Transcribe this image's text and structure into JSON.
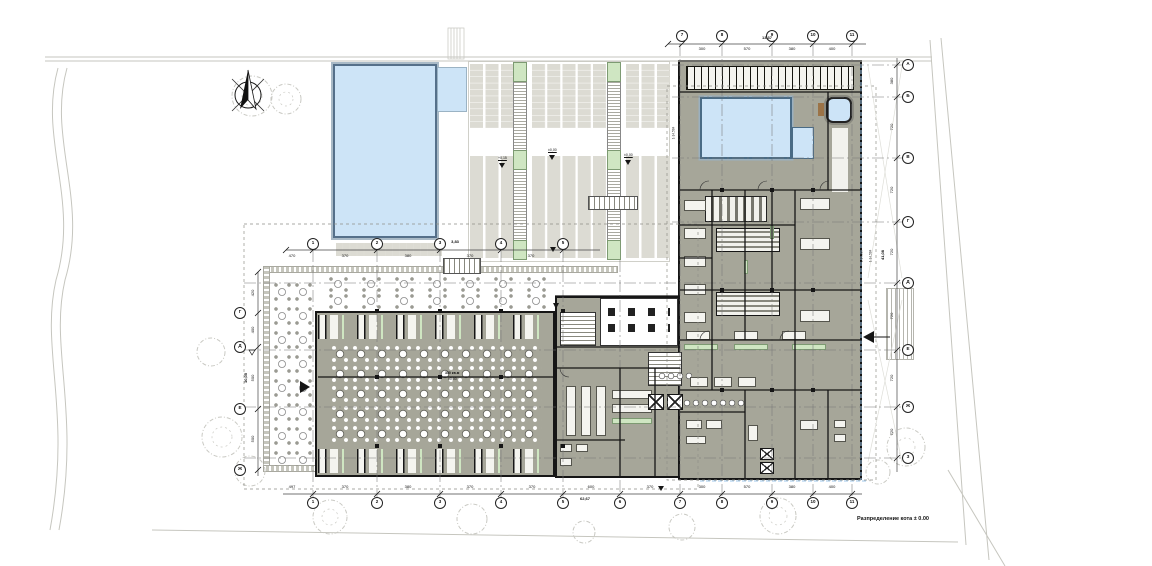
{
  "title": "Разпределение кота ± 0.00",
  "grid": {
    "cols_bottom": [
      "1",
      "2",
      "3",
      "4",
      "5",
      "6",
      "7",
      "8",
      "9",
      "10",
      "11"
    ],
    "cols_top": [
      "1",
      "2",
      "3",
      "4",
      "5"
    ],
    "cols_top_right": [
      "7",
      "8",
      "9",
      "10",
      "11"
    ],
    "rows_right": [
      "А",
      "Б",
      "В",
      "Г",
      "Д",
      "Е",
      "Ж",
      "З"
    ],
    "rows_left": [
      "Г",
      "Д",
      "Е",
      "Ж"
    ]
  },
  "dims": {
    "bottom": [
      "497",
      "370",
      "380",
      "370",
      "370",
      "600",
      "370",
      "300",
      "570",
      "380",
      "400"
    ],
    "bottom_total": "62,67",
    "top": [
      "470",
      "370",
      "380",
      "370",
      "370"
    ],
    "top_note": "3,83",
    "top_right": [
      "300",
      "570",
      "380",
      "400"
    ],
    "top_right_total": "13,37",
    "right": [
      "380",
      "720",
      "720",
      "720",
      "720",
      "720",
      "720"
    ],
    "right_total": "41,08",
    "left": [
      "420",
      "400",
      "500",
      "500"
    ],
    "left_total": "10,05"
  },
  "annotations": {
    "deck_note_1": "+0,15",
    "deck_note_2": "±0,00",
    "deck_note_3": "±0,00",
    "hall_area": "350 кв.м",
    "hall_level": "±0,00",
    "slope_1": "1-14.584",
    "slope_2": "1-14.584",
    "slope_3": "1-14.584"
  },
  "colors": {
    "floor": "#a6a699",
    "water": "#cde4f7",
    "accent_green": "#cfe6c2",
    "walls": "#161616",
    "site_lines": "#c6c6bf",
    "blue_dash": "#9cc6e8"
  }
}
